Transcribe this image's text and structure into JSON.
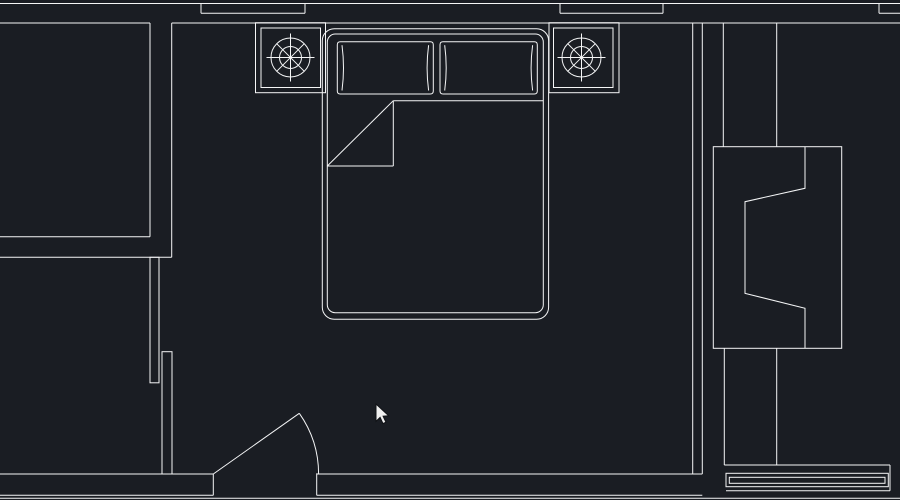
{
  "canvas": {
    "width": 900,
    "height": 500,
    "background_color": "#1a1d23",
    "line_color": "#f5f6f7",
    "stroke_width": 1,
    "description": "CAD model-space viewport showing a bedroom floor plan"
  },
  "cursor": {
    "x": 376,
    "y": 404
  },
  "drawing": {
    "style": {
      "stroke": "#f5f6f7",
      "stroke_width": 1
    },
    "groups": [
      {
        "name": "top-wall",
        "interactable": false,
        "shapes": [
          {
            "t": "line",
            "name": "top-wall-outer-edge",
            "p": [
              0,
              3.5,
              900,
              3.5
            ]
          },
          {
            "t": "line",
            "name": "top-wall-inner-edge-left",
            "p": [
              0,
              23,
              150,
              23
            ]
          },
          {
            "t": "line",
            "name": "top-wall-inner-edge",
            "p": [
              171.7,
              23,
              900,
              23
            ]
          },
          {
            "t": "line",
            "name": "window-1-line",
            "p": [
              201,
              13.3,
              305,
              13.3
            ]
          },
          {
            "t": "line",
            "name": "window-1-jamb-left",
            "p": [
              201,
              3.5,
              201,
              13.3
            ]
          },
          {
            "t": "line",
            "name": "window-1-jamb-right",
            "p": [
              305,
              3.5,
              305,
              13.3
            ]
          },
          {
            "t": "line",
            "name": "window-2-line",
            "p": [
              560,
              13.3,
              663,
              13.3
            ]
          },
          {
            "t": "line",
            "name": "window-2-jamb-left",
            "p": [
              560,
              3.5,
              560,
              13.3
            ]
          },
          {
            "t": "line",
            "name": "window-2-jamb-right",
            "p": [
              663,
              3.5,
              663,
              13.3
            ]
          },
          {
            "t": "line",
            "name": "window-3-line",
            "p": [
              879,
              13.3,
              900,
              13.3
            ]
          },
          {
            "t": "line",
            "name": "window-3-jamb",
            "p": [
              879,
              3.5,
              879,
              13.3
            ]
          }
        ]
      },
      {
        "name": "left-room",
        "interactable": false,
        "shapes": [
          {
            "t": "line",
            "name": "left-room-east-wall-inner",
            "p": [
              150,
              23,
              150,
              236.7
            ]
          },
          {
            "t": "line",
            "name": "left-room-south-wall-inner",
            "p": [
              0,
              236.7,
              150,
              236.7
            ]
          },
          {
            "t": "line",
            "name": "left-room-south-wall-outer",
            "p": [
              0,
              257.3,
              171.7,
              257.3
            ]
          },
          {
            "t": "line",
            "name": "left-room-east-wall-outer",
            "p": [
              171.7,
              23,
              171.7,
              257.3
            ]
          }
        ]
      },
      {
        "name": "partition-wall-stubs",
        "interactable": false,
        "shapes": [
          {
            "t": "rect",
            "name": "wall-stub-upper",
            "p": [
              150,
              257.3,
              9,
              125.5
            ]
          },
          {
            "t": "rect",
            "name": "wall-stub-lower",
            "p": [
              162,
              351.7,
              10,
              122.3
            ]
          }
        ]
      },
      {
        "name": "bottom-wall",
        "interactable": false,
        "shapes": [
          {
            "t": "line",
            "name": "bottom-wall-left-top-edge",
            "p": [
              0,
              474,
              213.3,
              474
            ]
          },
          {
            "t": "line",
            "name": "door-jamb-left",
            "p": [
              213.3,
              474,
              213.3,
              495.3
            ]
          },
          {
            "t": "line",
            "name": "bottom-wall-left-bottom-edge",
            "p": [
              0,
              495.3,
              213.3,
              495.3
            ]
          },
          {
            "t": "line",
            "name": "door-jamb-right",
            "p": [
              316.7,
              473.3,
              316.7,
              495.3
            ]
          },
          {
            "t": "line",
            "name": "bottom-wall-right-top-edge",
            "p": [
              316.7,
              474,
              702.3,
              474
            ]
          },
          {
            "t": "line",
            "name": "bottom-wall-right-bottom-edge",
            "p": [
              316.7,
              495.3,
              702.3,
              495.3
            ]
          },
          {
            "t": "line",
            "name": "bottom-boundary-line",
            "p": [
              0,
              498.3,
              900,
              498.3
            ]
          }
        ]
      },
      {
        "name": "door",
        "interactable": false,
        "shapes": [
          {
            "t": "line",
            "name": "door-leaf",
            "p": [
              213.3,
              474,
              299.3,
              413.3
            ]
          },
          {
            "t": "path",
            "name": "door-swing-arc",
            "p": "M299.3 413.3 A105.3 105.3 0 0 1 318.6 474"
          }
        ]
      },
      {
        "name": "right-wall",
        "interactable": false,
        "shapes": [
          {
            "t": "line",
            "name": "right-wall-inner-line",
            "p": [
              692.7,
              23,
              692.7,
              474
            ]
          },
          {
            "t": "line",
            "name": "right-wall-outer-line",
            "p": [
              702.3,
              23,
              702.3,
              474
            ]
          },
          {
            "t": "line",
            "name": "column-left-line",
            "p": [
              723.3,
              23,
              723.3,
              146.7
            ]
          },
          {
            "t": "line",
            "name": "column-right-line",
            "p": [
              776.7,
              23,
              776.7,
              146.7
            ]
          },
          {
            "t": "line",
            "name": "lower-column-left-line",
            "p": [
              724.3,
              348.3,
              724.3,
              465
            ]
          },
          {
            "t": "line",
            "name": "lower-column-right-line",
            "p": [
              776.7,
              348.3,
              776.7,
              465
            ]
          }
        ]
      },
      {
        "name": "bed",
        "interactable": false,
        "shapes": [
          {
            "t": "rect",
            "name": "bed-outline-outer",
            "p": [
              322.3,
              28.7,
              226.3,
              290.6
            ],
            "rx": 12
          },
          {
            "t": "rect",
            "name": "bed-outline-inner",
            "p": [
              327.3,
              34,
              216,
              278.7
            ],
            "rx": 8
          },
          {
            "t": "line",
            "name": "blanket-edge",
            "p": [
              393.3,
              100.7,
              543.3,
              100.7
            ]
          },
          {
            "t": "line",
            "name": "sheet-fold-diagonal",
            "p": [
              327.3,
              166,
              393.3,
              100.7
            ]
          },
          {
            "t": "line",
            "name": "sheet-fold-right-edge",
            "p": [
              393.3,
              100.7,
              393.3,
              166
            ]
          },
          {
            "t": "line",
            "name": "sheet-fold-bottom-edge",
            "p": [
              327.3,
              166,
              393.3,
              166
            ]
          }
        ]
      },
      {
        "name": "pillow-left",
        "interactable": false,
        "shapes": [
          {
            "t": "path",
            "name": "pillow-left-outline",
            "p": "M340.3 41.7 L430.3 41.7 Q433.3 41.7 433.3 44.7 L433.3 91 Q433.3 94 430.3 94 L340.3 94 Q337.3 94 337.3 91 L337.3 44.7 Q337.3 41.7 340.3 41.7 Z"
          },
          {
            "t": "path",
            "name": "pillow-left-seam-left",
            "p": "M342 45.2 Q345 67.8 342 90.5"
          },
          {
            "t": "path",
            "name": "pillow-left-seam-right",
            "p": "M428.6 45.2 Q425.6 67.8 428.6 90.5"
          }
        ]
      },
      {
        "name": "pillow-right",
        "interactable": false,
        "shapes": [
          {
            "t": "path",
            "name": "pillow-right-outline",
            "p": "M443 41.7 L534.3 41.7 Q537.3 41.7 537.3 44.7 L537.3 91 Q537.3 94 534.3 94 L443 94 Q440 94 440 91 L440 44.7 Q440 41.7 443 41.7 Z"
          },
          {
            "t": "path",
            "name": "pillow-right-seam-left",
            "p": "M444.7 45.2 Q447.7 67.8 444.7 90.5"
          },
          {
            "t": "path",
            "name": "pillow-right-seam-right",
            "p": "M532.6 45.2 Q529.6 67.8 532.6 90.5"
          }
        ]
      },
      {
        "name": "nightstand-left",
        "interactable": false,
        "shapes": [
          {
            "t": "rect",
            "name": "nightstand-left-outer",
            "p": [
              255.5,
              22.7,
              70,
              70
            ]
          },
          {
            "t": "rect",
            "name": "nightstand-left-inner",
            "p": [
              261,
              28,
              59.5,
              59.5
            ]
          }
        ]
      },
      {
        "name": "lamp-symbol-left",
        "interactable": false,
        "shapes": [
          {
            "t": "circle",
            "name": "lamp-left-outer-circle",
            "p": [
              290.5,
              57.5,
              19.5
            ]
          },
          {
            "t": "circle",
            "name": "lamp-left-inner-circle",
            "p": [
              290.5,
              57.5,
              11
            ]
          },
          {
            "t": "line",
            "name": "lamp-left-spoke-h",
            "p": [
              266.5,
              57.5,
              314.5,
              57.5
            ]
          },
          {
            "t": "line",
            "name": "lamp-left-spoke-v",
            "p": [
              290.5,
              33.5,
              290.5,
              81.5
            ]
          },
          {
            "t": "line",
            "name": "lamp-left-spoke-d1",
            "p": [
              276.7,
              43.7,
              304.3,
              71.3
            ]
          },
          {
            "t": "line",
            "name": "lamp-left-spoke-d2",
            "p": [
              276.7,
              71.3,
              304.3,
              43.7
            ]
          }
        ]
      },
      {
        "name": "nightstand-right",
        "interactable": false,
        "shapes": [
          {
            "t": "rect",
            "name": "nightstand-right-outer",
            "p": [
              549,
              22.7,
              70,
              70
            ]
          },
          {
            "t": "rect",
            "name": "nightstand-right-inner",
            "p": [
              553.5,
              28,
              59.5,
              59.5
            ]
          }
        ]
      },
      {
        "name": "lamp-symbol-right",
        "interactable": false,
        "shapes": [
          {
            "t": "circle",
            "name": "lamp-right-outer-circle",
            "p": [
              581.5,
              57.5,
              19.5
            ]
          },
          {
            "t": "circle",
            "name": "lamp-right-inner-circle",
            "p": [
              581.5,
              57.5,
              11
            ]
          },
          {
            "t": "line",
            "name": "lamp-right-spoke-h",
            "p": [
              557.5,
              57.5,
              605.5,
              57.5
            ]
          },
          {
            "t": "line",
            "name": "lamp-right-spoke-v",
            "p": [
              581.5,
              33.5,
              581.5,
              81.5
            ]
          },
          {
            "t": "line",
            "name": "lamp-right-spoke-d1",
            "p": [
              567.7,
              43.7,
              595.3,
              71.3
            ]
          },
          {
            "t": "line",
            "name": "lamp-right-spoke-d2",
            "p": [
              567.7,
              71.3,
              595.3,
              43.7
            ]
          }
        ]
      },
      {
        "name": "wardrobe",
        "interactable": false,
        "shapes": [
          {
            "t": "rect",
            "name": "wardrobe-outline",
            "p": [
              713.3,
              146.7,
              128.4,
              201.6
            ]
          },
          {
            "t": "polyline",
            "name": "wardrobe-door-panel",
            "p": "805,146.7 805,188.3 745,201.7 745,293.3 805,308.3 805,348.3"
          }
        ]
      },
      {
        "name": "window-sill-bottom-right",
        "interactable": false,
        "shapes": [
          {
            "t": "line",
            "name": "sill-top-line",
            "p": [
              724.3,
              465,
              890,
              465
            ]
          },
          {
            "t": "line",
            "name": "sill-right-edge",
            "p": [
              890,
              465,
              890,
              490.7
            ]
          },
          {
            "t": "line",
            "name": "sill-bottom-line",
            "p": [
              726,
              490.7,
              890,
              490.7
            ]
          },
          {
            "t": "rect",
            "name": "sill-outer-rect",
            "p": [
              726,
              473.3,
              162.3,
              13.4
            ]
          },
          {
            "t": "rect",
            "name": "sill-inner-rect",
            "p": [
              729.3,
              477.3,
              155.7,
              6
            ]
          }
        ]
      },
      {
        "name": "mouse-cursor",
        "interactable": false,
        "fill": "#f0f0f0",
        "stroke": "#101216",
        "shapes": [
          {
            "t": "path",
            "name": "cursor-arrow-icon",
            "p": "M376 404 L376 421.3 L380.1 417.4 L383 423.6 L385.9 422.2 L383.1 416.2 L388.7 415.8 Z"
          }
        ]
      }
    ]
  }
}
